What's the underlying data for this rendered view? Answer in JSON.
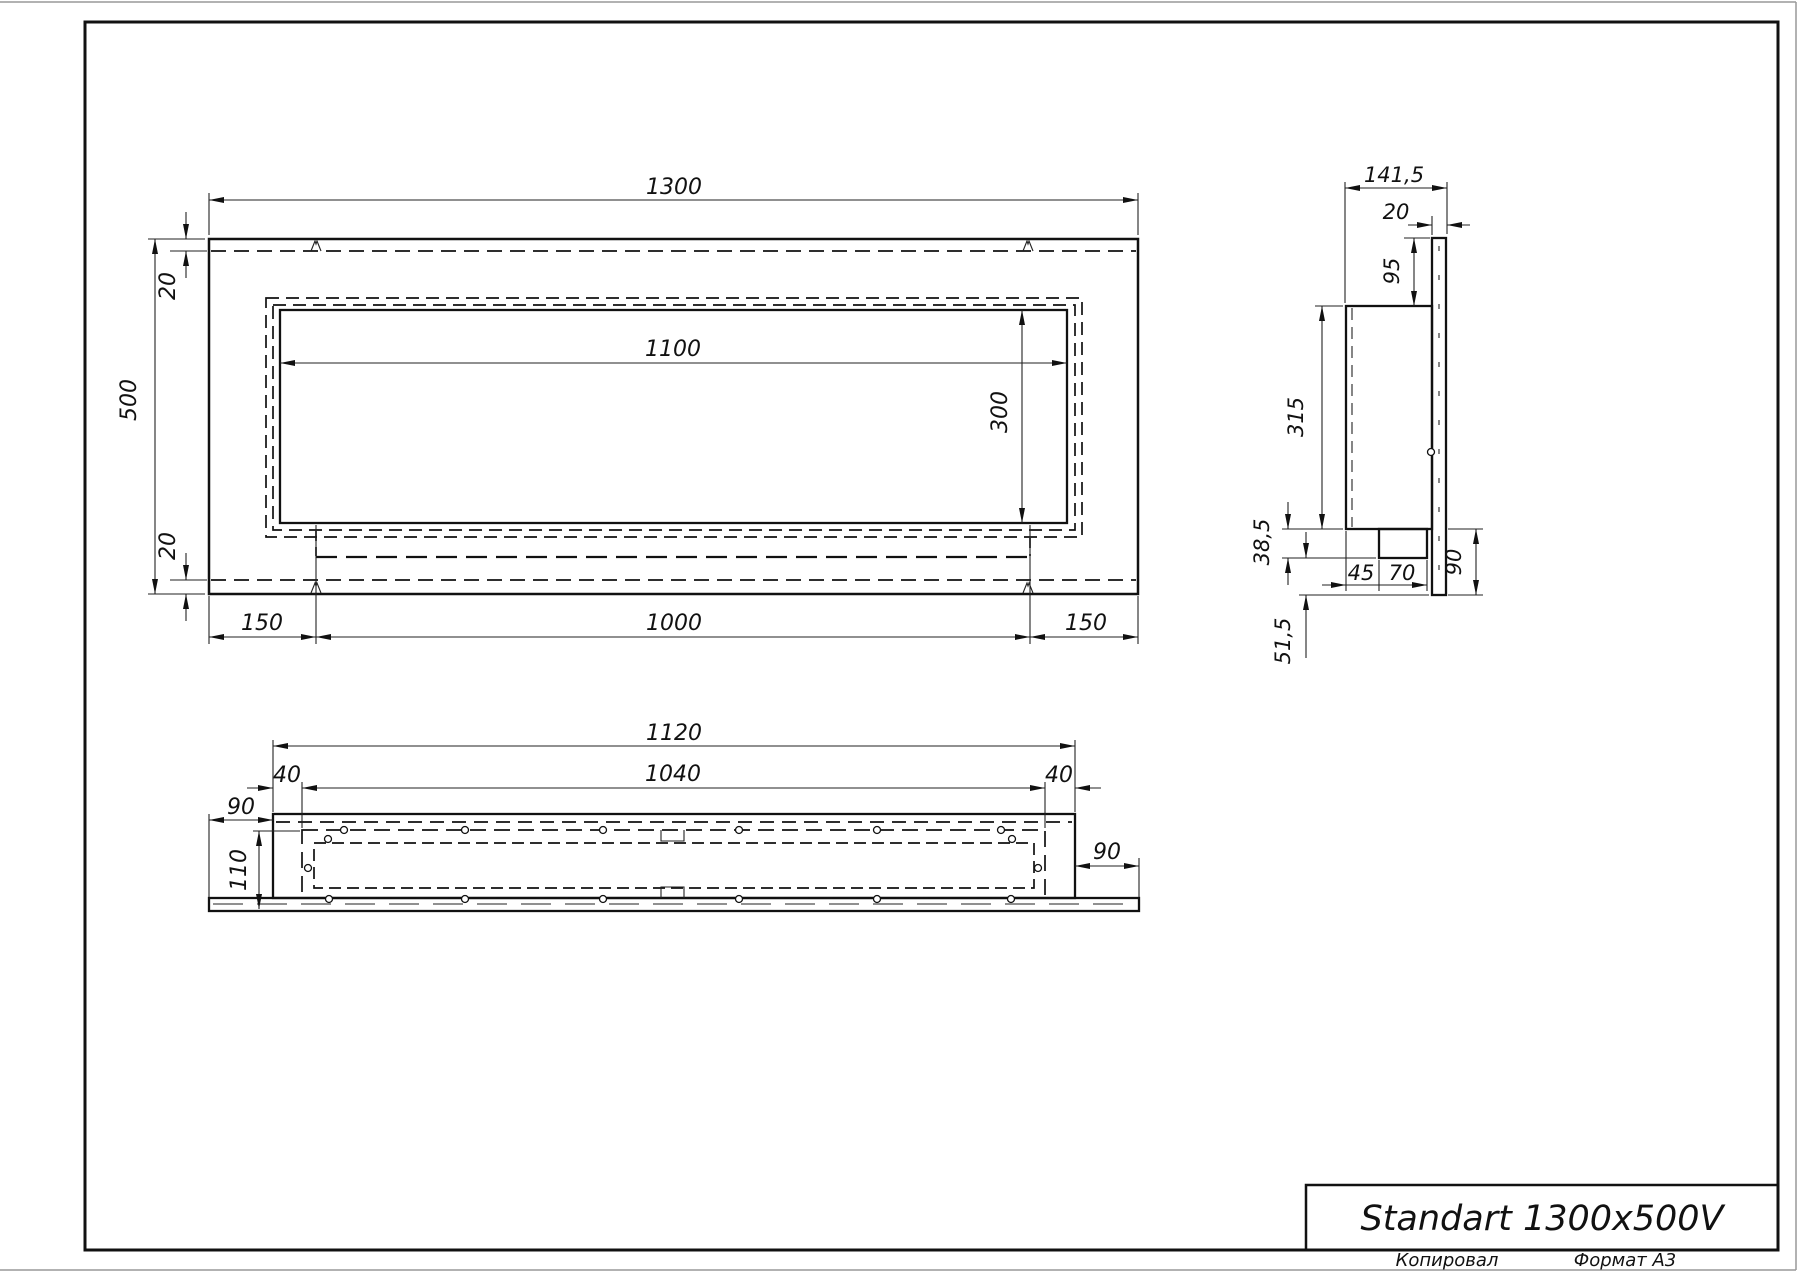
{
  "title_block": {
    "title": "Standart 1300x500V"
  },
  "footer": {
    "copied_label": "Копировал",
    "format_label": "Формат А3"
  },
  "front_view": {
    "dims": {
      "overall_width": "1300",
      "overall_height": "500",
      "border_top": "20",
      "border_bottom": "20",
      "opening_width": "1100",
      "opening_height": "300",
      "bottom_left": "150",
      "bottom_center": "1000",
      "bottom_right": "150"
    }
  },
  "side_view": {
    "dims": {
      "overall_depth": "141,5",
      "flange_thickness": "20",
      "top_offset": "95",
      "body_height": "315",
      "tray_drop": "38,5",
      "tray_offset": "45",
      "tray_depth": "70",
      "flange_bottom_offset": "90",
      "bottom_drop": "51,5"
    }
  },
  "bottom_view": {
    "dims": {
      "body_width": "1120",
      "tray_width": "1040",
      "inset_left": "40",
      "inset_right": "40",
      "flange_left": "90",
      "flange_right": "90",
      "total_depth": "110"
    }
  }
}
